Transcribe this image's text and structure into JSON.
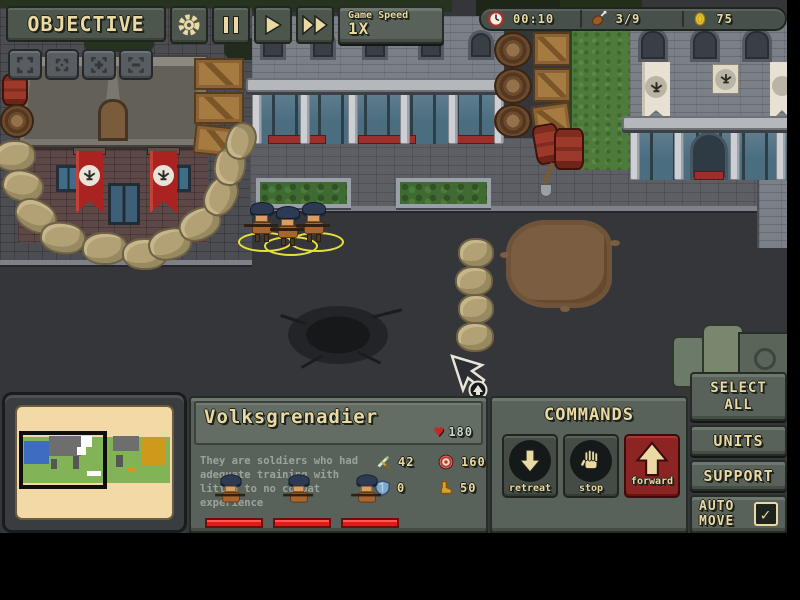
{
  "colors": {
    "ui_panel": "#59625a",
    "ui_text": "#ead9a3",
    "accent_red": "#a32822",
    "health_bar_red": "#dd1d1d",
    "selection_yellow": "#e6e03a",
    "road_gray": "#35363a",
    "grass_green": "#4e7a3c",
    "minimap_paper": "#f3d9a5"
  },
  "toolbar": {
    "objective_label": "OBJECTIVE",
    "game_speed_label": "Game Speed",
    "game_speed_value": "1X"
  },
  "resources": {
    "timer": "00:10",
    "food": "3/9",
    "coins": "75"
  },
  "unit_panel": {
    "name": "Volksgrenadier",
    "health": "180",
    "description": "They are soldiers who had adequate training with little to no combat experience",
    "stats": {
      "attack": "42",
      "range": "160",
      "defense": "0",
      "speed": "50"
    }
  },
  "commands": {
    "title": "COMMANDS",
    "retreat_label": "retreat",
    "stop_label": "stop",
    "forward_label": "forward"
  },
  "side_panel": {
    "select_all_label": "SELECT ALL",
    "units_label": "UNITS",
    "support_label": "SUPPORT",
    "auto_move_label": "AUTO MOVE",
    "auto_move_checked": true,
    "check_glyph": "✓"
  }
}
